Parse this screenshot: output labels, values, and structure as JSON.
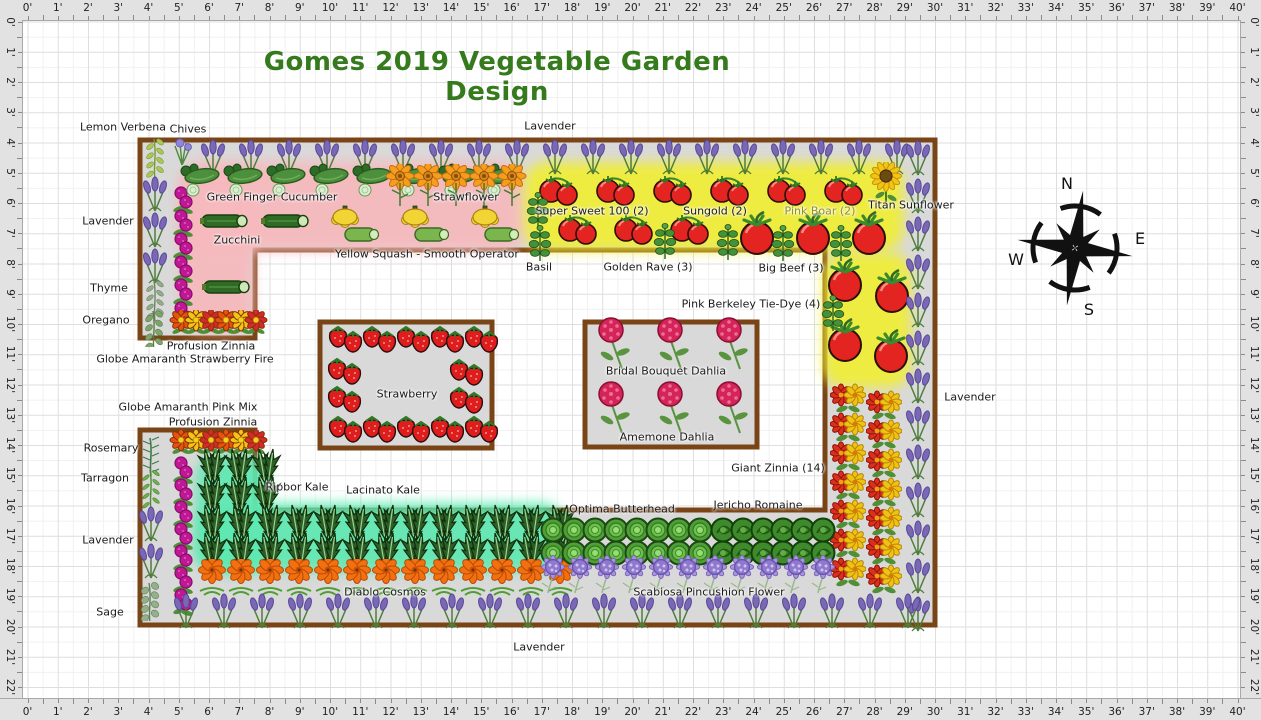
{
  "title": {
    "text": "Gomes 2019 Vegetable Garden Design"
  },
  "compass": {
    "n": "N",
    "e": "E",
    "s": "S",
    "w": "W"
  },
  "rulers": {
    "unit": "'",
    "horizontal_max_ft": 40,
    "vertical_max_ft": 22
  },
  "colors": {
    "title": "#357a1d",
    "bed_fill": "#d9d9d9",
    "bed_border": "#7a4516",
    "pink_zone": "#f7b9bd",
    "yellow_zone": "#f0ee35",
    "teal_zone": "#5fead4",
    "ruler_bg": "#e2e2e2",
    "label_text": "#1a1a1a",
    "pink_boar_label": "#8f8f2a"
  },
  "beds": {
    "main_path": "M140,140 L935,140 L935,625 L140,625 L140,430 L255,430 L255,510 L825,510 L825,250 L255,250 L255,338 L140,338 Z",
    "islands": [
      {
        "name": "strawberry-bed",
        "x": 320,
        "y": 322,
        "w": 172,
        "h": 126
      },
      {
        "name": "dahlia-bed",
        "x": 585,
        "y": 322,
        "w": 172,
        "h": 125
      }
    ]
  },
  "highlights": [
    {
      "name": "pink-cucumber-zone",
      "x": 180,
      "y": 162,
      "w": 344,
      "h": 89,
      "c": "#f7b9bd"
    },
    {
      "name": "pink-zucchini-zone",
      "x": 180,
      "y": 170,
      "w": 74,
      "h": 162,
      "c": "#f7b9bd"
    },
    {
      "name": "yellow-tomato-zone",
      "x": 524,
      "y": 162,
      "w": 380,
      "h": 89,
      "c": "#f0ee35"
    },
    {
      "name": "yellow-tomato-right",
      "x": 823,
      "y": 252,
      "w": 88,
      "h": 136,
      "c": "#f0ee35"
    },
    {
      "name": "teal-kale-block",
      "x": 196,
      "y": 455,
      "w": 72,
      "h": 117,
      "c": "#5fe9b2"
    },
    {
      "name": "teal-kale-strip",
      "x": 196,
      "y": 503,
      "w": 368,
      "h": 69,
      "c": "#5fe9b2"
    }
  ],
  "plants": [
    {
      "t": "chives",
      "x": 182,
      "y": 152
    },
    {
      "t": "lemon-verbena",
      "x": 155,
      "y": 158
    },
    {
      "t": "lavender",
      "x": 155,
      "y": 194,
      "n": 3,
      "dy": 36
    },
    {
      "t": "thyme",
      "x": 155,
      "y": 300
    },
    {
      "t": "oregano",
      "x": 154,
      "y": 327
    },
    {
      "t": "lavender",
      "x": 213,
      "y": 157,
      "n": 19,
      "dx": 38
    },
    {
      "t": "amaranth",
      "x": 183,
      "y": 200,
      "n": 6,
      "dy": 23
    },
    {
      "t": "cucumber",
      "x": 200,
      "y": 180,
      "n": 8,
      "dx": 43
    },
    {
      "t": "zucchini",
      "x": 224,
      "y": 221
    },
    {
      "t": "zucchini",
      "x": 285,
      "y": 221
    },
    {
      "t": "zucchini",
      "x": 226,
      "y": 287
    },
    {
      "t": "squash",
      "x": 352,
      "y": 226,
      "n": 3,
      "dx": 70
    },
    {
      "t": "strawflower",
      "x": 400,
      "y": 186,
      "n": 5,
      "dx": 28
    },
    {
      "t": "zinnia-small",
      "x": 181,
      "y": 323,
      "n": 6,
      "dx": 15
    },
    {
      "t": "tomato-pair",
      "x": 558,
      "y": 189,
      "n": 6,
      "dx": 57
    },
    {
      "t": "tomato-pair",
      "x": 577,
      "y": 228,
      "n": 3,
      "dx": 56
    },
    {
      "t": "tomato-big",
      "x": 757,
      "y": 234,
      "n": 3,
      "dx": 56
    },
    {
      "t": "basil",
      "x": 538,
      "y": 210
    },
    {
      "t": "basil",
      "x": 540,
      "y": 243
    },
    {
      "t": "basil",
      "x": 665,
      "y": 241
    },
    {
      "t": "basil",
      "x": 728,
      "y": 242
    },
    {
      "t": "basil",
      "x": 783,
      "y": 243
    },
    {
      "t": "basil",
      "x": 841,
      "y": 243
    },
    {
      "t": "sunflower",
      "x": 886,
      "y": 183
    },
    {
      "t": "tomato-big",
      "x": 845,
      "y": 281
    },
    {
      "t": "tomato-big",
      "x": 892,
      "y": 292
    },
    {
      "t": "tomato-big",
      "x": 845,
      "y": 341
    },
    {
      "t": "tomato-big",
      "x": 891,
      "y": 352
    },
    {
      "t": "basil",
      "x": 833,
      "y": 313
    },
    {
      "t": "lavender",
      "x": 918,
      "y": 158,
      "n": 13,
      "dy": 38
    },
    {
      "t": "zinnia-giant",
      "x": 848,
      "y": 399,
      "n": 7,
      "dy": 29
    },
    {
      "t": "zinnia-giant",
      "x": 884,
      "y": 406,
      "n": 7,
      "dy": 29
    },
    {
      "t": "strawberry",
      "x": 345,
      "y": 341,
      "n": 5,
      "dx": 34
    },
    {
      "t": "strawberry",
      "x": 345,
      "y": 431,
      "n": 5,
      "dx": 34
    },
    {
      "t": "strawberry",
      "x": 344,
      "y": 373
    },
    {
      "t": "strawberry",
      "x": 344,
      "y": 401
    },
    {
      "t": "strawberry",
      "x": 466,
      "y": 374
    },
    {
      "t": "strawberry",
      "x": 466,
      "y": 402
    },
    {
      "t": "dahlia",
      "x": 613,
      "y": 345,
      "n": 3,
      "dx": 59
    },
    {
      "t": "dahlia",
      "x": 613,
      "y": 409,
      "n": 3,
      "dx": 59
    },
    {
      "t": "zinnia-small",
      "x": 181,
      "y": 443,
      "n": 6,
      "dx": 15
    },
    {
      "t": "rosemary",
      "x": 151,
      "y": 456
    },
    {
      "t": "tarragon",
      "x": 151,
      "y": 489
    },
    {
      "t": "lavender",
      "x": 151,
      "y": 524,
      "n": 2,
      "dy": 37
    },
    {
      "t": "sage",
      "x": 151,
      "y": 600
    },
    {
      "t": "amaranth",
      "x": 183,
      "y": 470,
      "n": 7,
      "dy": 22
    },
    {
      "t": "kale",
      "x": 212,
      "y": 466,
      "n": 3,
      "dx": 27
    },
    {
      "t": "kale",
      "x": 212,
      "y": 494,
      "n": 3,
      "dx": 27
    },
    {
      "t": "kale",
      "x": 212,
      "y": 522,
      "n": 13,
      "dx": 29
    },
    {
      "t": "kale",
      "x": 212,
      "y": 550,
      "n": 13,
      "dx": 29
    },
    {
      "t": "cosmos",
      "x": 212,
      "y": 579,
      "n": 13,
      "dx": 29
    },
    {
      "t": "butterhead",
      "x": 553,
      "y": 530,
      "n": 8,
      "dx": 21
    },
    {
      "t": "butterhead",
      "x": 553,
      "y": 553,
      "n": 8,
      "dx": 21
    },
    {
      "t": "romaine",
      "x": 723,
      "y": 530,
      "n": 6,
      "dx": 20
    },
    {
      "t": "romaine",
      "x": 723,
      "y": 553,
      "n": 6,
      "dx": 20
    },
    {
      "t": "scabiosa",
      "x": 553,
      "y": 575,
      "n": 11,
      "dx": 27
    },
    {
      "t": "lavender",
      "x": 186,
      "y": 611,
      "n": 20,
      "dx": 38
    }
  ],
  "labels": [
    {
      "text": "Lemon Verbena",
      "x": 123,
      "y": 127
    },
    {
      "text": "Chives",
      "x": 188,
      "y": 129
    },
    {
      "text": "Lavender",
      "x": 550,
      "y": 126
    },
    {
      "text": "Green Finger Cucumber",
      "x": 272,
      "y": 197
    },
    {
      "text": "Strawflower",
      "x": 466,
      "y": 197
    },
    {
      "text": "Zucchini",
      "x": 237,
      "y": 240
    },
    {
      "text": "Yellow Squash - Smooth Operator",
      "x": 427,
      "y": 254
    },
    {
      "text": "Basil",
      "x": 539,
      "y": 267
    },
    {
      "text": "Super Sweet 100 (2)",
      "x": 592,
      "y": 211
    },
    {
      "text": "Sungold (2)",
      "x": 715,
      "y": 211
    },
    {
      "text": "Pink Boar (2)",
      "x": 820,
      "y": 211,
      "color": "#8f8f2a"
    },
    {
      "text": "Titan Sunflower",
      "x": 911,
      "y": 205
    },
    {
      "text": "Golden Rave (3)",
      "x": 648,
      "y": 267
    },
    {
      "text": "Big Beef (3)",
      "x": 791,
      "y": 268
    },
    {
      "text": "Pink Berkeley Tie-Dye (4)",
      "x": 751,
      "y": 304
    },
    {
      "text": "Lavender",
      "x": 108,
      "y": 221
    },
    {
      "text": "Thyme",
      "x": 109,
      "y": 288
    },
    {
      "text": "Oregano",
      "x": 106,
      "y": 320
    },
    {
      "text": "Profusion Zinnia",
      "x": 211,
      "y": 346
    },
    {
      "text": "Globe Amaranth Strawberry Fire",
      "x": 185,
      "y": 359
    },
    {
      "text": "Strawberry",
      "x": 407,
      "y": 394
    },
    {
      "text": "Bridal Bouquet Dahlia",
      "x": 666,
      "y": 371
    },
    {
      "text": "Amemone Dahlia",
      "x": 667,
      "y": 437
    },
    {
      "text": "Lavender",
      "x": 970,
      "y": 397
    },
    {
      "text": "Globe Amaranth Pink Mix",
      "x": 188,
      "y": 407
    },
    {
      "text": "Profusion Zinnia",
      "x": 213,
      "y": 422
    },
    {
      "text": "Rosemary",
      "x": 111,
      "y": 448
    },
    {
      "text": "Tarragon",
      "x": 105,
      "y": 478
    },
    {
      "text": "Ripbor Kale",
      "x": 297,
      "y": 487
    },
    {
      "text": "Lacinato Kale",
      "x": 383,
      "y": 490
    },
    {
      "text": "Giant Zinnia (14)",
      "x": 778,
      "y": 468
    },
    {
      "text": "Optima Butterhead",
      "x": 622,
      "y": 509
    },
    {
      "text": "Jericho Romaine",
      "x": 758,
      "y": 505
    },
    {
      "text": "Lavender",
      "x": 108,
      "y": 540
    },
    {
      "text": "Diablo Cosmos",
      "x": 385,
      "y": 592
    },
    {
      "text": "Scabiosa Pincushion Flower",
      "x": 709,
      "y": 592
    },
    {
      "text": "Sage",
      "x": 110,
      "y": 612
    },
    {
      "text": "Lavender",
      "x": 539,
      "y": 647
    }
  ]
}
